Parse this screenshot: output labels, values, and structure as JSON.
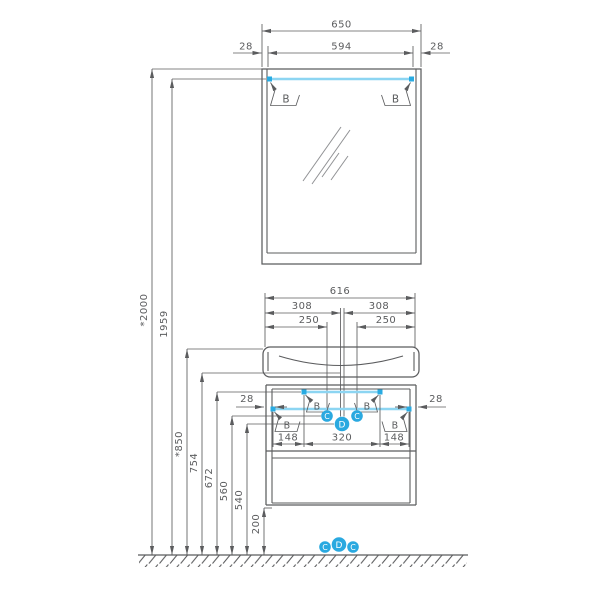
{
  "labels": {
    "hook": "B",
    "supply": "C",
    "drain": "D"
  },
  "dims": {
    "mirror": {
      "overall": "650",
      "rail": "594",
      "gap_left": "28",
      "gap_right": "28"
    },
    "heights": [
      {
        "label": "*2000"
      },
      {
        "label": "1959"
      },
      {
        "label": "*850"
      },
      {
        "label": "754"
      },
      {
        "label": "672"
      },
      {
        "label": "560"
      },
      {
        "label": "540"
      },
      {
        "label": "200"
      }
    ],
    "vanity": {
      "overall": "616",
      "half_left": "308",
      "half_right": "308",
      "offset_left": "250",
      "offset_right": "250",
      "gap_left": "28",
      "gap_right": "28",
      "span_left": "148",
      "span_center": "320",
      "span_right": "148"
    }
  },
  "colors": {
    "line": "#5B5C5E",
    "rail": "#8CD5F2",
    "accent": "#29ABE2",
    "point_fill": "#2AA9E0",
    "point_text": "#FFFFFF",
    "background": "#FFFFFF"
  }
}
